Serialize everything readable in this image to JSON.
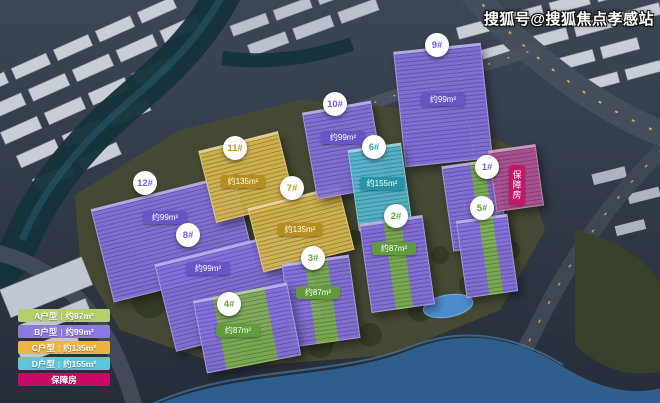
{
  "watermark": {
    "text": "搜狐号@搜狐焦点孝感站"
  },
  "legend": {
    "separator": "|",
    "items": [
      {
        "label": "A户型",
        "area": "约87m²",
        "color": "#b5cf6d"
      },
      {
        "label": "B户型",
        "area": "约99m²",
        "color": "#8d79e4"
      },
      {
        "label": "C户型",
        "area": "约135m²",
        "color": "#ecb53d"
      },
      {
        "label": "D户型",
        "area": "约155m²",
        "color": "#5ec6da"
      },
      {
        "label": "保障房",
        "area": "",
        "color": "#c50b66"
      }
    ]
  },
  "buildings": [
    {
      "number": "12#",
      "area": "约99m²",
      "color": "#8672dd"
    },
    {
      "number": "8#",
      "area": "约99m²",
      "color": "#8672dd"
    },
    {
      "number": "11#",
      "area": "约135m²",
      "color": "#d9b94b"
    },
    {
      "number": "7#",
      "area": "约135m²",
      "color": "#d9b94b"
    },
    {
      "number": "10#",
      "area": "约99m²",
      "color": "#8672dd"
    },
    {
      "number": "9#",
      "area": "约99m²",
      "color": "#8672dd"
    },
    {
      "number": "6#",
      "area": "约155m²",
      "color": "#54b9cd"
    },
    {
      "number": "1#",
      "tag": "保障房",
      "color": "#8672dd"
    },
    {
      "number": "2#",
      "area": "约87m²",
      "color": "#7fb052"
    },
    {
      "number": "3#",
      "area": "约87m²",
      "color": "#7fb052"
    },
    {
      "number": "4#",
      "area": "约87m²",
      "color": "#7fb052"
    },
    {
      "number": "5#",
      "color": "#7fb052"
    }
  ]
}
